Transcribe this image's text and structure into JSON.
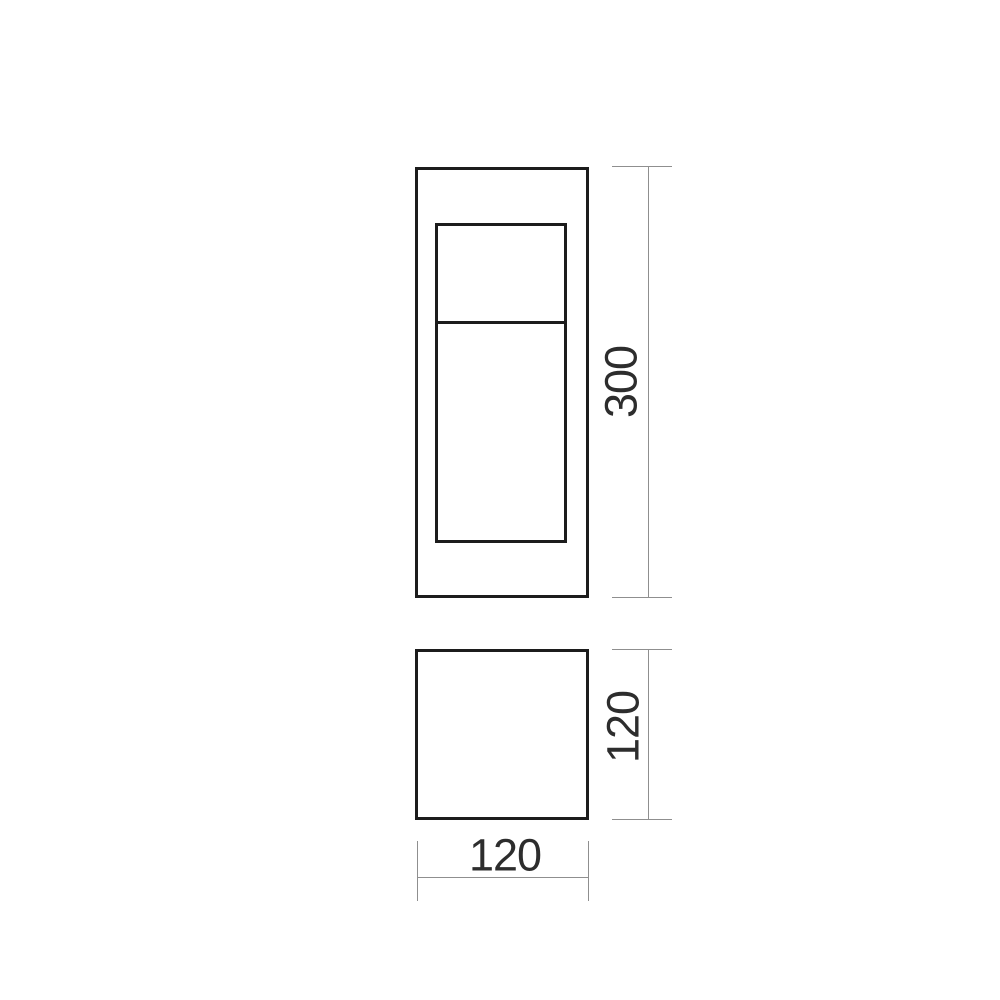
{
  "drawing": {
    "type": "technical-dimension-drawing",
    "dimensions": {
      "height": {
        "value": "300",
        "orientation": "vertical"
      },
      "depth": {
        "value": "120",
        "orientation": "vertical"
      },
      "width": {
        "value": "120",
        "orientation": "horizontal"
      }
    },
    "colors": {
      "outline": "#1c1c1c",
      "dimension_line": "#8f8f8f",
      "label_text": "#2d2d2d",
      "background": "#ffffff"
    }
  }
}
